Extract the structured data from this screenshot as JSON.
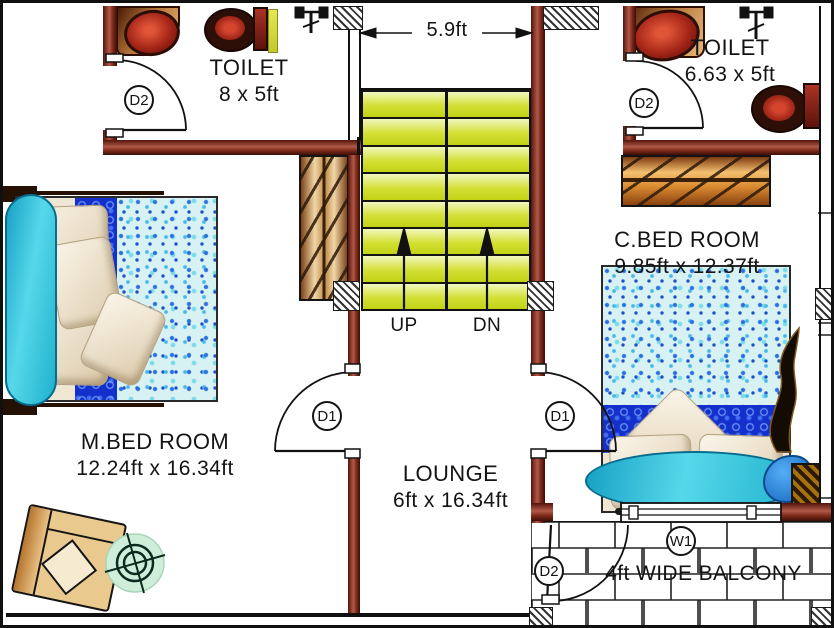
{
  "rooms": {
    "toilet_left": {
      "label": "TOILET",
      "dimensions": "8 x 5ft"
    },
    "toilet_right": {
      "label": "TOILET",
      "dimensions": "6.63 x 5ft"
    },
    "m_bedroom": {
      "label": "M.BED ROOM",
      "dimensions": "12.24ft x 16.34ft"
    },
    "c_bedroom": {
      "label": "C.BED ROOM",
      "dimensions": "9.85ft x 12.37ft"
    },
    "lounge": {
      "label": "LOUNGE",
      "dimensions": "6ft x 16.34ft"
    },
    "balcony": {
      "label": "4ft WIDE BALCONY"
    }
  },
  "stairs": {
    "width_dimension": "5.9ft",
    "up_label": "UP",
    "down_label": "DN"
  },
  "tags": {
    "door_d1": "D1",
    "door_d2": "D2",
    "window_w1": "W1"
  },
  "colors": {
    "wall_maroon": "#7e2a1a",
    "stair_tread_green": "#d3e035",
    "fixture_red": "#8d1b10",
    "headboard_teal": "#2fb9cf"
  }
}
